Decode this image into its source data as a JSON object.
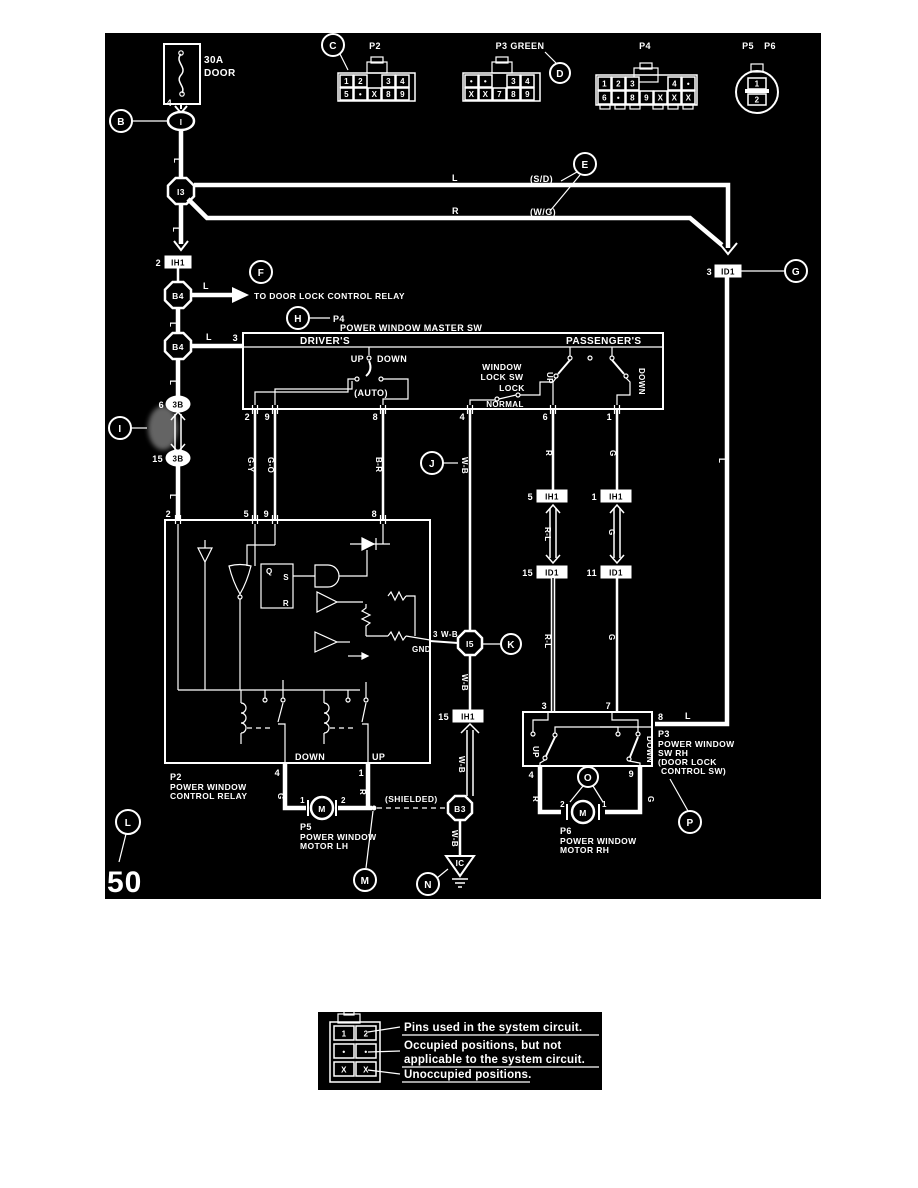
{
  "diagram": {
    "page_number": "50",
    "fuse": {
      "rating": "30A",
      "name": "DOOR",
      "pin": "4"
    },
    "to_door_lock": "TO DOOR LOCK CONTROL RELAY",
    "callouts": {
      "b": "B",
      "c": "C",
      "d": "D",
      "e": "E",
      "f": "F",
      "g": "G",
      "h": "H",
      "i": "I",
      "j": "J",
      "k": "K",
      "l": "L",
      "m": "M",
      "n": "N",
      "o": "O",
      "p": "P"
    },
    "connectors": {
      "p2": {
        "title": "P2",
        "row1": [
          "1",
          "2",
          "3",
          "4"
        ],
        "row2": [
          "5",
          "•",
          "X",
          "8",
          "9"
        ]
      },
      "p3": {
        "title": "P3 GREEN",
        "row1": [
          "•",
          "•",
          "3",
          "4"
        ],
        "row2": [
          "X",
          "X",
          "7",
          "8",
          "9"
        ]
      },
      "p4": {
        "title": "P4",
        "row1": [
          "1",
          "2",
          "3",
          "4",
          "•"
        ],
        "row2": [
          "6",
          "•",
          "8",
          "9",
          "X",
          "X",
          "X"
        ]
      },
      "p5p6": {
        "p5": "P5",
        "p6": "P6",
        "pin1": "1",
        "pin2": "2"
      }
    },
    "nodes": {
      "top": "I",
      "i3": "I3",
      "b4a": "B4",
      "b4b": "B4",
      "oval3b_a": "3B",
      "oval3b_a_pin": "6",
      "oval3b_b": "3B",
      "oval3b_b_pin": "15",
      "i5": "I5",
      "b3": "B3",
      "gnd": "IC"
    },
    "inline": {
      "ih1_a": {
        "pin": "2",
        "name": "IH1"
      },
      "id1_a": {
        "pin": "3",
        "name": "ID1"
      },
      "ih1_b": {
        "pin": "5",
        "name": "IH1"
      },
      "id1_b": {
        "pin": "15",
        "name": "ID1"
      },
      "ih1_c": {
        "pin": "1",
        "name": "IH1"
      },
      "id1_c": {
        "pin": "11",
        "name": "ID1"
      },
      "ih1_d": {
        "pin": "15",
        "name": "IH1"
      }
    },
    "wires": {
      "l": "L",
      "r": "R",
      "sd": "(S/D)",
      "wg": "(W/G)",
      "gy": "G-Y",
      "go": "G-O",
      "br": "B-R",
      "wb": "W-B",
      "rl": "R-L",
      "g": "G",
      "shielded": "(SHIELDED)"
    },
    "master_sw": {
      "ref": "P4",
      "title": "POWER WINDOW MASTER SW",
      "drivers": "DRIVER'S",
      "passengers": "PASSENGER'S",
      "up": "UP",
      "down": "DOWN",
      "auto": "(AUTO)",
      "lock1": "WINDOW",
      "lock2": "LOCK SW",
      "lock": "LOCK",
      "normal": "NORMAL",
      "pin_in": "3",
      "pins": [
        "2",
        "9",
        "8",
        "4",
        "6",
        "1"
      ]
    },
    "relay": {
      "ref": "P2",
      "name1": "POWER WINDOW",
      "name2": "CONTROL RELAY",
      "pins_top": [
        "2",
        "5",
        "9",
        "8"
      ],
      "pin_gnd": "3",
      "gnd_label": "GND",
      "down": "DOWN",
      "up": "UP",
      "pins_bottom": [
        "4",
        "1"
      ],
      "ff": {
        "q": "Q",
        "s": "S",
        "r": "R"
      }
    },
    "motor_lh": {
      "ref": "P5",
      "name1": "POWER WINDOW",
      "name2": "MOTOR LH",
      "pin1": "1",
      "pin2": "2",
      "m": "M"
    },
    "motor_rh": {
      "ref": "P6",
      "name1": "POWER WINDOW",
      "name2": "MOTOR RH",
      "pin1": "1",
      "pin2": "2",
      "m": "M"
    },
    "sw_rh": {
      "ref": "P3",
      "name1": "POWER WINDOW",
      "name2": "SW RH",
      "name3": "(DOOR LOCK",
      "name4": "CONTROL SW)",
      "pins_top": [
        "3",
        "7"
      ],
      "pin_l": "8",
      "pins_bottom": [
        "4",
        "9"
      ],
      "up": "UP",
      "down": "DOWN"
    },
    "colors": {
      "background": "#ffffff",
      "panel": "#000000",
      "line": "#ffffff"
    }
  },
  "legend": {
    "cells": {
      "row1": [
        "1",
        "2"
      ],
      "row2": [
        "•",
        "•"
      ],
      "row3": [
        "X",
        "X"
      ]
    },
    "line1": "Pins used in the system circuit.",
    "line2": "Occupied positions, but not",
    "line3": "applicable to the system circuit.",
    "line4": "Unoccupied positions."
  }
}
